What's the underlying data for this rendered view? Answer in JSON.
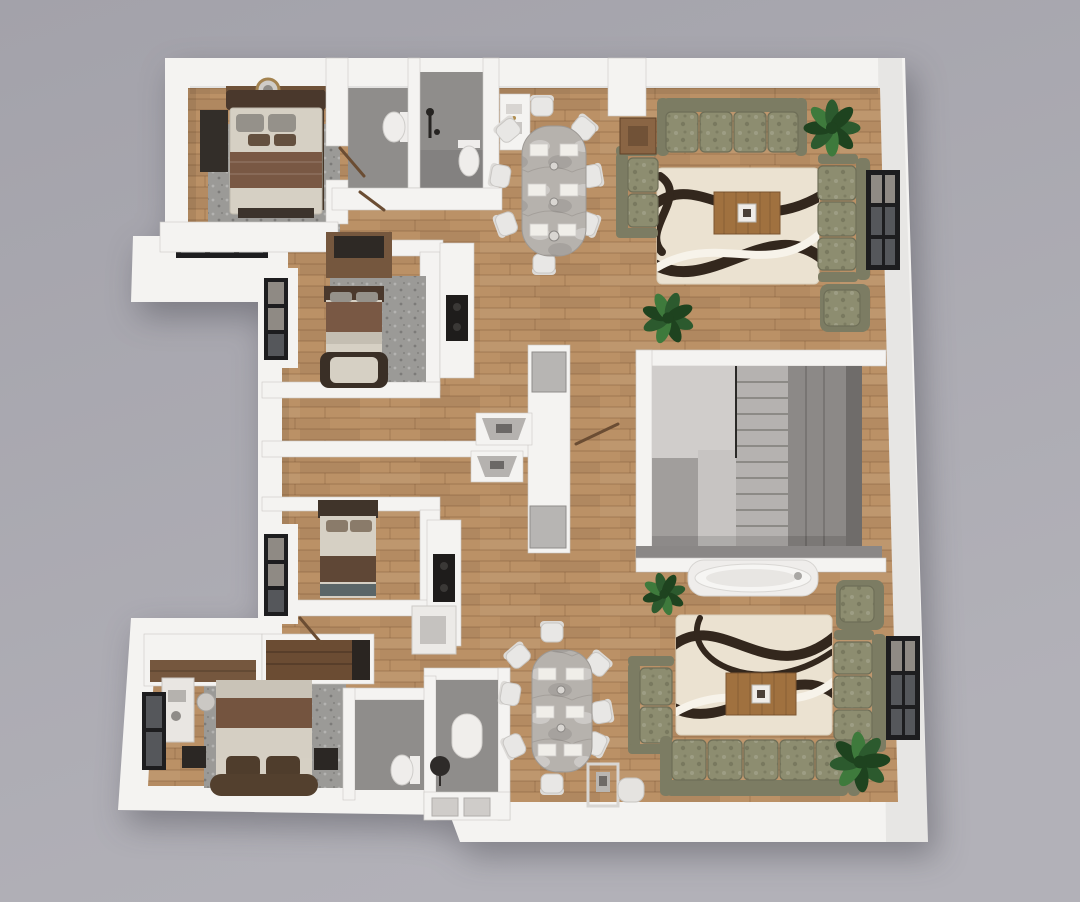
{
  "meta": {
    "description": "3D rendered top-down floor plan of a residential storey with two mirrored apartment units: bedrooms with beds and rugs, two bathrooms per unit, kitchen counters, marble dining tables with eight chairs, olive-green sofa living rooms with swirl-pattern rugs, a central staircase core, a freestanding bathtub and potted plants"
  },
  "palette": {
    "bg_top": "#a3a2aa",
    "bg_bottom": "#b2b1b8",
    "wall": "#f4f3f1",
    "wall_shade": "#dedcd9",
    "wall_edge": "#cac8c5",
    "wood": "#bb9166",
    "wood_line": "#5c3c1e",
    "bath_floor": "#8f8d8b",
    "stair_room": "#a19e9c",
    "stair_landing": "#d0cdcb",
    "stair_tread": "#b5b2b0",
    "stair_dark": "#8c8987",
    "stair_shadow": "#6f6c6a",
    "rug_cream": "#ebe2d1",
    "rug_swirl": "#33271d",
    "rug_swirl_light": "#f7f3ea",
    "rug_gray": "#9b9a97",
    "sofa": "#8d8d70",
    "sofa_back": "#7c7c63",
    "sofa_line": "#6e6e57",
    "marble": "#b6b2ad",
    "chair": "#e8e7e5",
    "chair_edge": "#c9c7c4",
    "coffee_wood": "#a0713f",
    "side_wood": "#8a6544",
    "bed_cream": "#d6d0c4",
    "blanket_brown": "#795844",
    "blanket_dark": "#5f4736",
    "pillow_gray": "#95918a",
    "pillow_brown": "#64503f",
    "headboard": "#4a382c",
    "wardrobe_dark": "#332e29",
    "wardrobe_wood": "#75573e",
    "window_frame": "#1d1d1f",
    "window_glass": "#8f8a84",
    "window_glass_dark": "#55575b",
    "plant": "#2c5a2e",
    "plant_dark": "#1e431f",
    "plant_light": "#3e7a3c",
    "pot": "#d2d0ce",
    "fixture": "#262422",
    "porcelain": "#efedeb",
    "cooktop": "#1e1c1b",
    "tub": "#f6f5f3",
    "door_wood": "#6b4d33"
  }
}
